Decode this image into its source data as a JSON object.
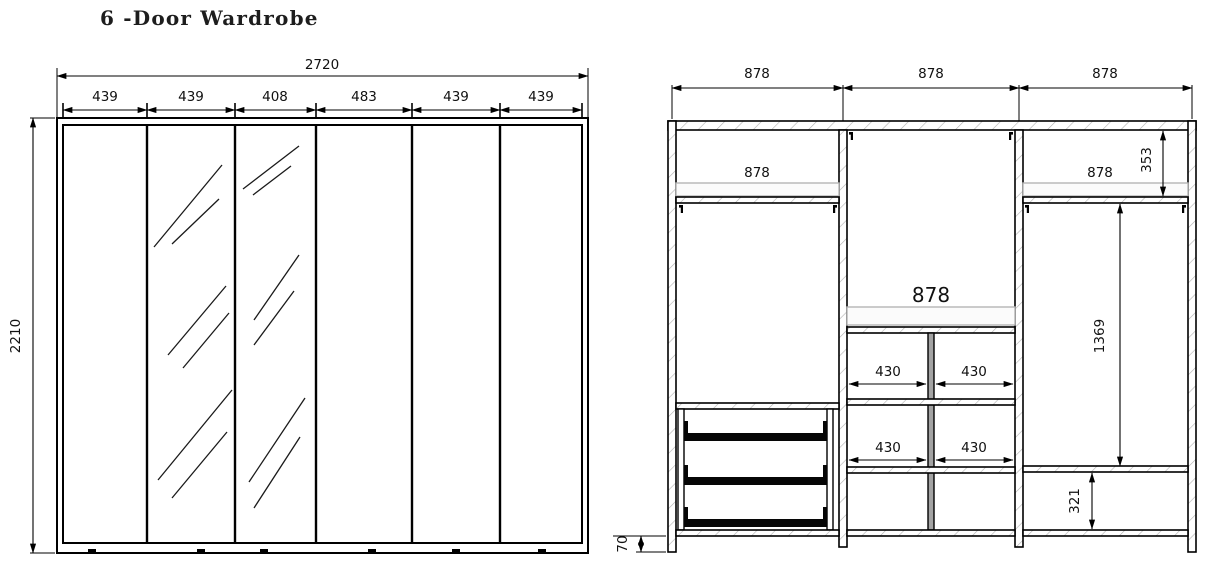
{
  "title": "6 -Door Wardrobe",
  "front_view": {
    "overall_width": "2720",
    "overall_height": "2210",
    "door_widths": [
      "439",
      "439",
      "408",
      "483",
      "439",
      "439"
    ]
  },
  "internal_view": {
    "section_widths": [
      "878",
      "878",
      "878"
    ],
    "left_section": {
      "shelf_width": "878"
    },
    "middle_section": {
      "hanging_width": "878",
      "cubby_row1": [
        "430",
        "430"
      ],
      "cubby_row2": [
        "430",
        "430"
      ]
    },
    "right_section": {
      "shelf_width": "878",
      "top_compartment_height": "353",
      "hanging_height": "1369",
      "bottom_compartment_height": "321"
    },
    "plinth_height": "70"
  }
}
